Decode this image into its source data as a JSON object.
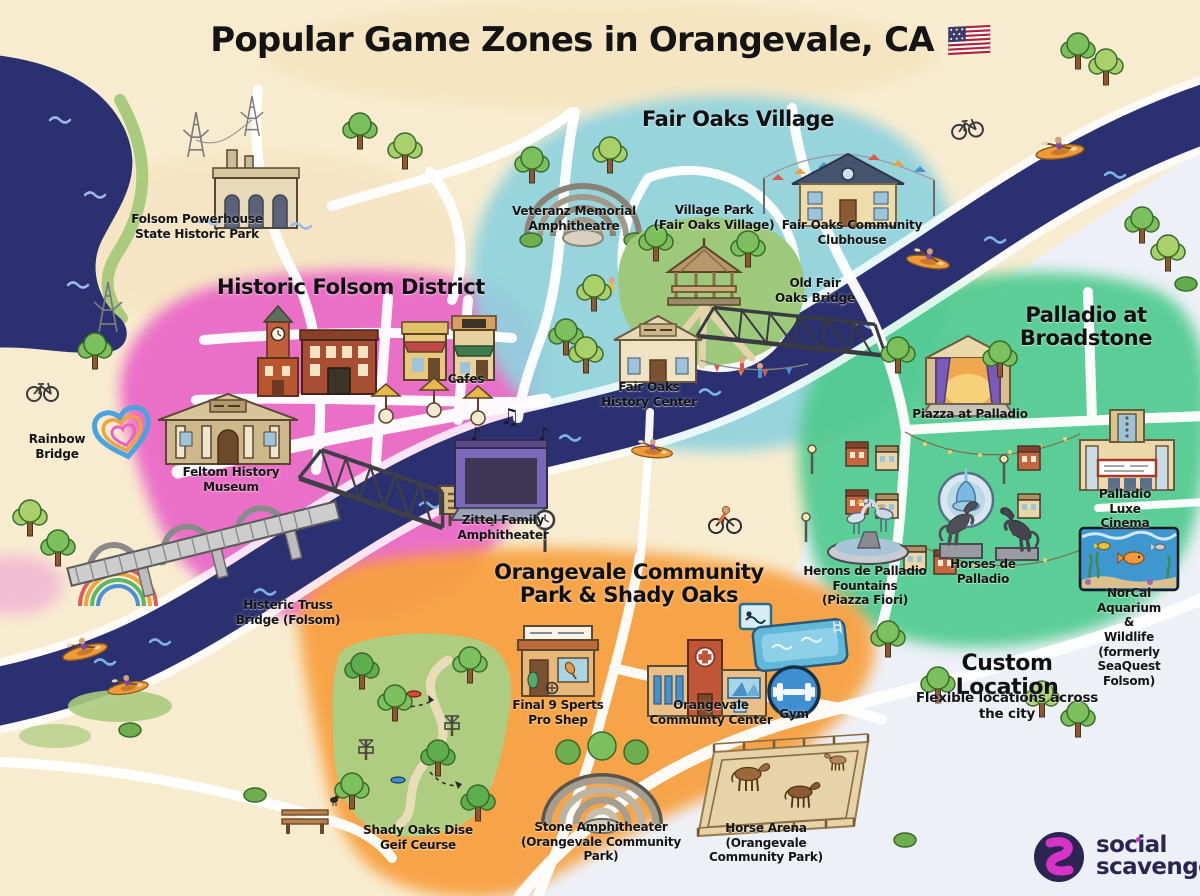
{
  "title": {
    "text": "Popular Game Zones in Orangevale, CA",
    "flag_icon": "us-flag"
  },
  "zones": {
    "folsom": {
      "title": "Historic Folsom District",
      "color": "#e95fc6"
    },
    "fairoaks": {
      "title": "Fair Oaks Village",
      "color": "#8fd2de"
    },
    "palladio": {
      "title": "Palladio at\nBroadstone",
      "color": "#4fca8e"
    },
    "orangevale": {
      "title": "Orangevale Community\nPark & Shady Oaks",
      "color": "#f7a03f"
    },
    "custom": {
      "title": "Custom Location",
      "subtitle": "Flexible locations across the city"
    }
  },
  "labels": {
    "powerhouse": "Folsom Powerhouse\nState Historic Park",
    "cafes": "Cafes",
    "museum": "Feltom History\nMuseum",
    "rainbow_bridge": "Rainbow\nBridge",
    "truss_bridge": "Histeric Truss\nBridge (Folsom)",
    "zittel": "Zittel Family\nAmphitheater",
    "veterans": "Veteranz Memorial\nAmphitheatre",
    "village_park": "Village Park\n(Fair Oaks Village)",
    "clubhouse": "Fair Oaks Community\nClubhouse",
    "old_bridge": "Old Fair\nOaks Bridge",
    "history_center": "Fair Oaks\nHistory Center",
    "piazza": "Piazza at Palladio",
    "cinema": "Palladio Luxe\nCinema",
    "herons": "Herons de Palladio\nFountains\n(Piazza Fiori)",
    "horses": "Horses de\nPalladio",
    "aquarium": "NorCal Aquarium &\nWildlife (formerly\nSeaQuest Folsom)",
    "pro_shop": "Final 9 Sperts\nPro Shep",
    "community_center": "Orangevale\nCommumty Center",
    "gym": "Gym",
    "disc_golf": "Shady Oaks Dise\nGeif Ceurse",
    "stone_amph": "Stone Amphitheater\n(Orangevale Community\nPark)",
    "horse_arena": "Horse Arena\n(Orangevale\nCommunity Park)"
  },
  "icons": {
    "music_note": "♪",
    "music_beam": "♫"
  },
  "logo": {
    "word1": "social",
    "word2": "scavenger",
    "period": "."
  }
}
